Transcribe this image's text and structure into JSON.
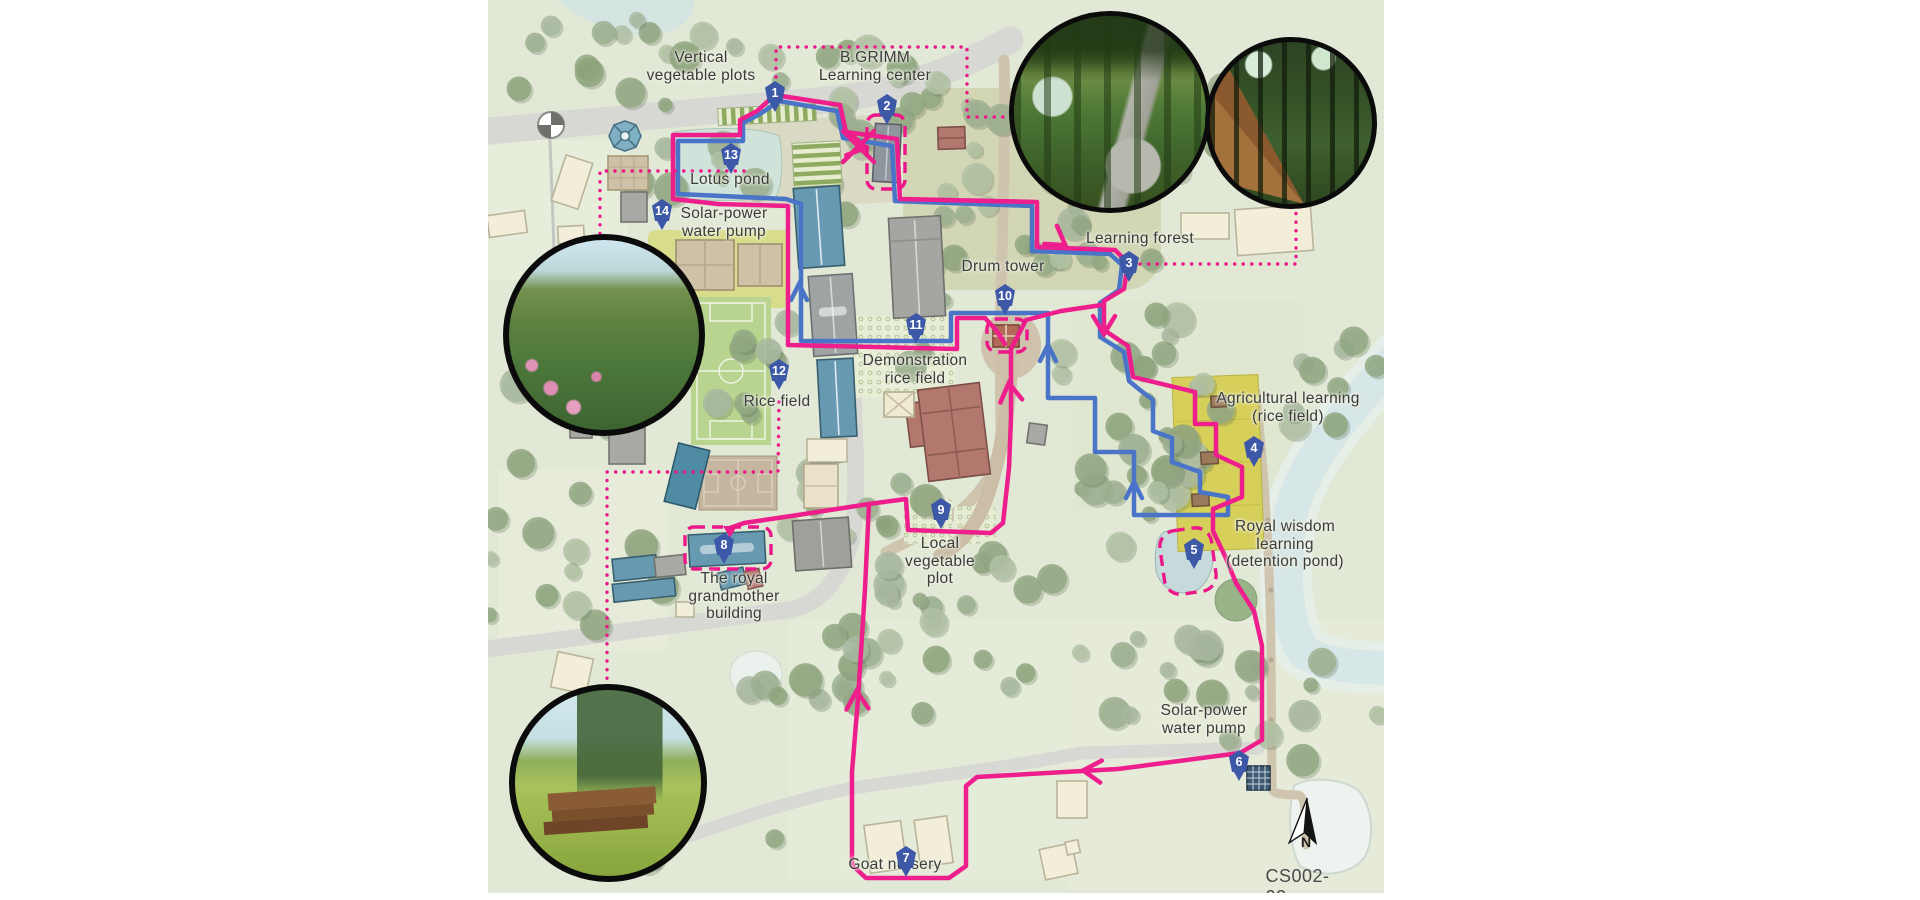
{
  "title_context": "B.GRIMM learning center site tour map",
  "drawing_code": "CS002-02",
  "compass_n": "N",
  "markers": [
    {
      "num": "1",
      "feature": "Vertical vegetable plots"
    },
    {
      "num": "2",
      "feature": "B.GRIMM Learning center"
    },
    {
      "num": "3",
      "feature": "Learning forest"
    },
    {
      "num": "4",
      "feature": "Agricultural learning (rice field)"
    },
    {
      "num": "5",
      "feature": "Royal wisdom learning (detention pond)"
    },
    {
      "num": "6",
      "feature": "Solar-power water pump"
    },
    {
      "num": "7",
      "feature": "Goat nursery"
    },
    {
      "num": "8",
      "feature": "The royal grandmother building"
    },
    {
      "num": "9",
      "feature": "Local vegetable plot"
    },
    {
      "num": "10",
      "feature": "Drum tower"
    },
    {
      "num": "11",
      "feature": "Demonstration rice field"
    },
    {
      "num": "12",
      "feature": "Rice field"
    },
    {
      "num": "13",
      "feature": "Lotus pond"
    },
    {
      "num": "14",
      "feature": "Solar-power water pump"
    }
  ],
  "labels": {
    "vertical_vegetable_plots": [
      "Vertical",
      "vegetable plots"
    ],
    "bgrimm": [
      "B.GRIMM",
      "Learning center"
    ],
    "learning_forest": [
      "Learning forest"
    ],
    "drum_tower": [
      "Drum tower"
    ],
    "lotus_pond": [
      "Lotus pond"
    ],
    "solar_pump_top": [
      "Solar-power",
      "water pump"
    ],
    "demonstration_rice_field": [
      "Demonstration",
      "rice field"
    ],
    "rice_field": [
      "Rice field"
    ],
    "agricultural_learning": [
      "Agricultural learning",
      "(rice field)"
    ],
    "royal_wisdom": [
      "Royal wisdom",
      "learning",
      "(detention pond)"
    ],
    "local_vegetable_plot": [
      "Local",
      "vegetable",
      "plot"
    ],
    "royal_grandmother": [
      "The royal",
      "grandmother",
      "building"
    ],
    "solar_pump_bottom": [
      "Solar-power",
      "water pump"
    ],
    "goat_nursery": [
      "Goat nursery"
    ]
  },
  "colors": {
    "walking_route_pink": "#ee1e8d",
    "secondary_route_blue": "#4a74c8",
    "marker_pin": "#3d58a7",
    "highlight_dashed": "#ec1788",
    "map_base": "#e2e8d6",
    "rice_field_yellow": "#d6cf5a",
    "river": "#d7e6e6"
  }
}
